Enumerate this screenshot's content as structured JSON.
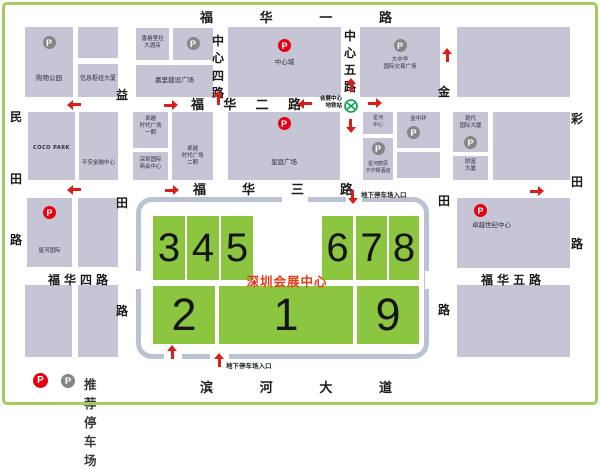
{
  "colors": {
    "block_fill": "#c6c5d6",
    "hall_green": "#8cc540",
    "ring_road": "#b9c3d4",
    "red_parking": "#e60012",
    "gray_parking": "#868686",
    "title_red": "#e83a17",
    "arrow_red": "#d8201a",
    "frame_green": "#a3cb5e",
    "metro_green": "#00a04a"
  },
  "icons": {
    "p_letter": "P"
  },
  "center": {
    "title": "深圳会展中心",
    "halls": {
      "h1": "1",
      "h2": "2",
      "h3": "3",
      "h4": "4",
      "h5": "5",
      "h6": "6",
      "h7": "7",
      "h8": "8",
      "h9": "9"
    }
  },
  "streets": {
    "fuhua1": "福华一路",
    "fuhua2": "福华二路",
    "fuhua3": "福华三路",
    "fuhua4": "福华四路",
    "fuhua5": "福华五路",
    "binhe_dadao": "滨河大道",
    "zhongxin4": "中心四路",
    "zhongxin5": "中心五路",
    "yitian": "益田路",
    "mintian": "民田路",
    "jintian": "金田路",
    "caitian": "彩田路"
  },
  "buildings": {
    "gouwu_gongyuan": "购物公园",
    "xinxi_shuniu": "信息枢纽大厦",
    "xianggelila": "香格里拉\n大酒店",
    "jiali": "嘉里建设广场",
    "zhongxincheng": "中心城",
    "dazhonghua": "大中华\n国际交易广场",
    "coco_park": "COCO PARK",
    "pingan": "平安金融中心",
    "zhuoyue_yiqi": "卓越\n时代广场\n一期",
    "shanghui": "深圳国际\n商会中心",
    "zhuoyue_erqi": "卓越\n时代广场\n二期",
    "wangting": "皇庭广场",
    "xinghe_zhongxin": "星河\n中心",
    "xinghe_lisi": "星河丽思\n卡尔顿酒店",
    "jinzhonghuan": "金中环",
    "xiandai": "现代\n国际大厦",
    "caifu": "财富\n大厦",
    "xinghe_guoji": "星河国际",
    "zhuoyue_shiji": "卓越世纪中心"
  },
  "metro_station": {
    "label": "会展中心\n地铁站"
  },
  "entrances": {
    "top": "地下停车场入口",
    "bottom": "地下停车场入口"
  },
  "legend": {
    "label": "推荐停车场"
  }
}
